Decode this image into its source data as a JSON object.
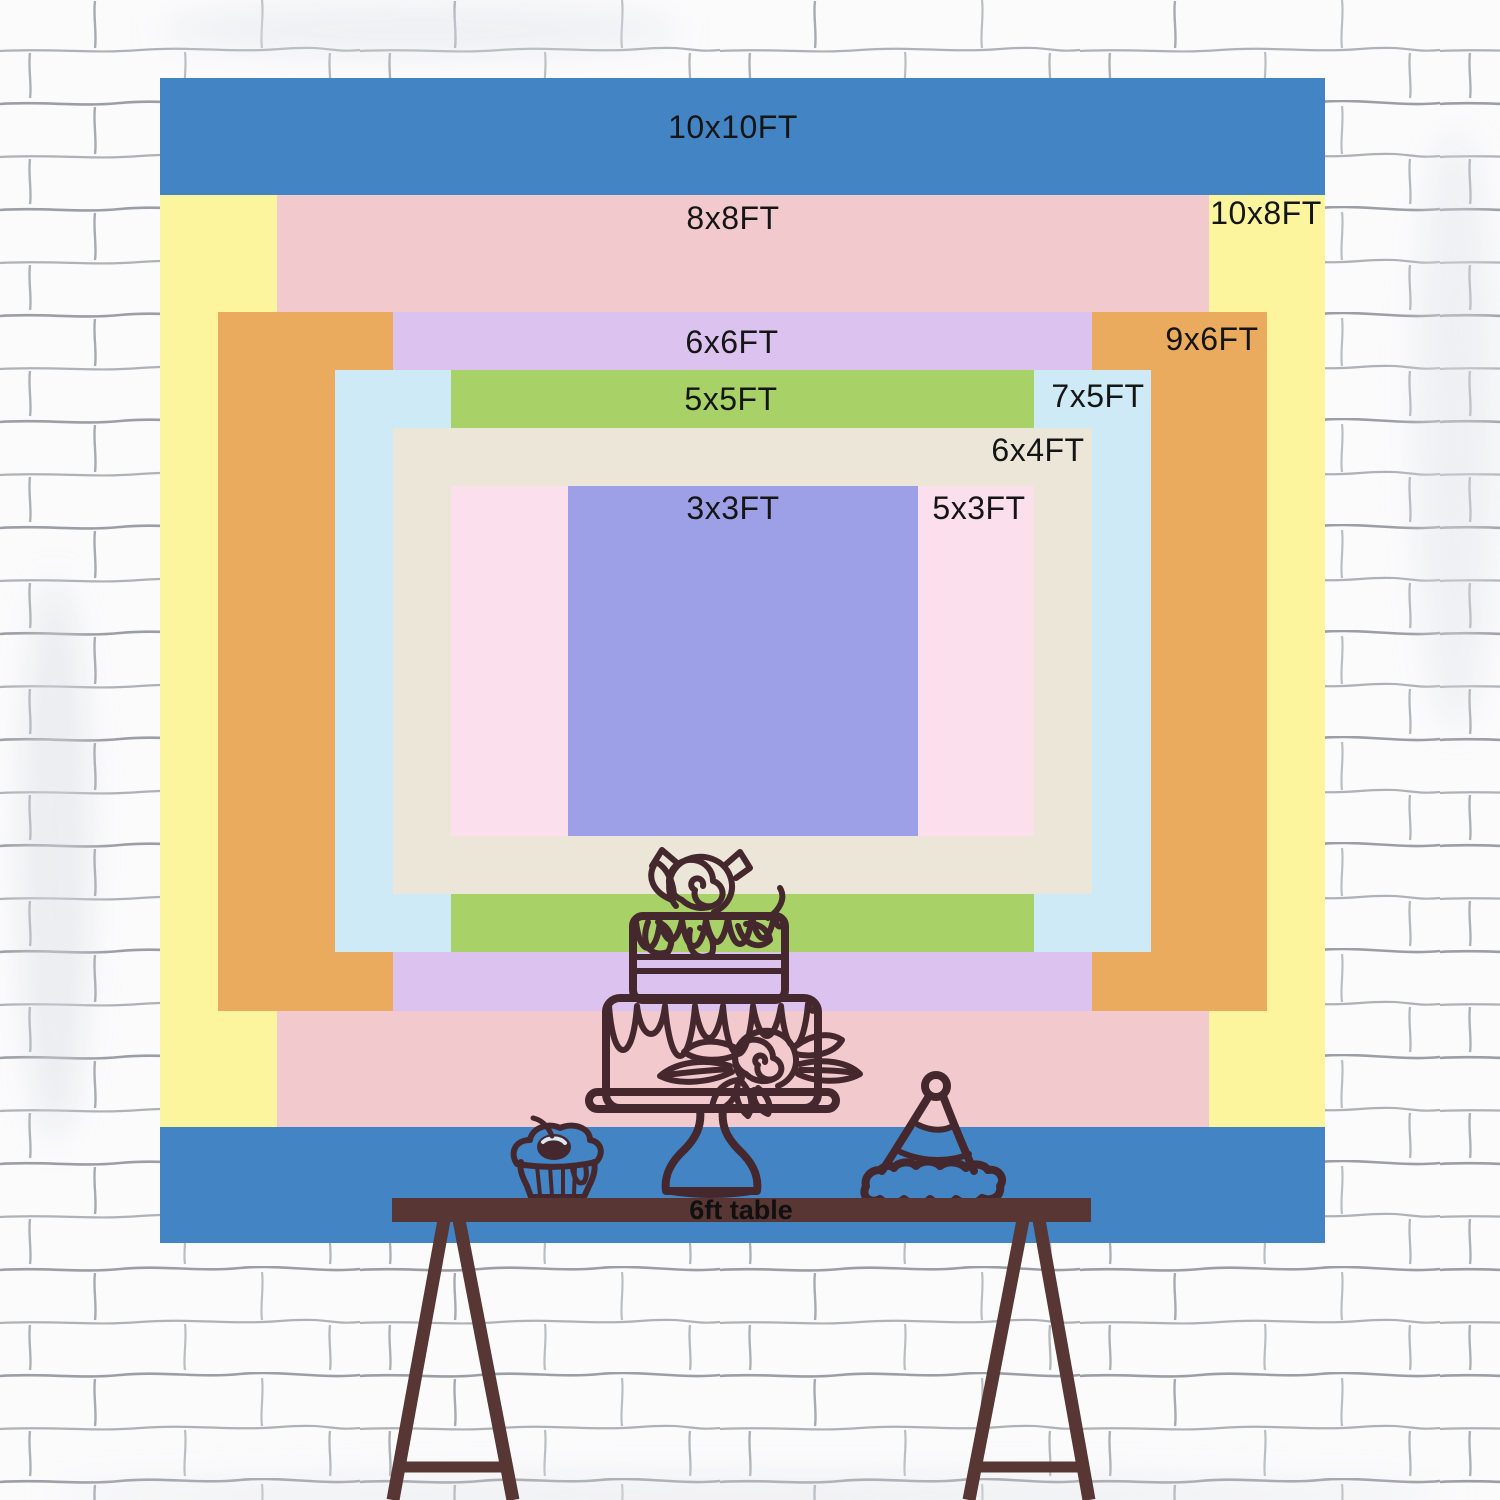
{
  "backdrop": {
    "description": "Backdrop size comparison chart, concentric colored rectangles",
    "layers": [
      {
        "label": "10x10FT",
        "size_ft": {
          "w": 10,
          "h": 10
        },
        "color": "#4284c4",
        "rect": {
          "x": 160,
          "y": 78,
          "w": 1165,
          "h": 1165
        },
        "label_pos": {
          "x": 733,
          "y": 127
        }
      },
      {
        "label": "10x8FT",
        "size_ft": {
          "w": 10,
          "h": 8
        },
        "color": "#fdf59e",
        "rect": {
          "x": 160,
          "y": 195,
          "w": 1165,
          "h": 932
        },
        "label_pos": {
          "x": 1266,
          "y": 213
        }
      },
      {
        "label": "8x8FT",
        "size_ft": {
          "w": 8,
          "h": 8
        },
        "color": "#f2cacd",
        "rect": {
          "x": 277,
          "y": 195,
          "w": 932,
          "h": 932
        },
        "label_pos": {
          "x": 733,
          "y": 218
        }
      },
      {
        "label": "9x6FT",
        "size_ft": {
          "w": 9,
          "h": 6
        },
        "color": "#ebab5f",
        "rect": {
          "x": 218,
          "y": 312,
          "w": 1049,
          "h": 699
        },
        "label_pos": {
          "x": 1212,
          "y": 339
        }
      },
      {
        "label": "6x6FT",
        "size_ft": {
          "w": 6,
          "h": 6
        },
        "color": "#dbc2ef",
        "rect": {
          "x": 393,
          "y": 312,
          "w": 699,
          "h": 699
        },
        "label_pos": {
          "x": 732,
          "y": 342
        }
      },
      {
        "label": "7x5FT",
        "size_ft": {
          "w": 7,
          "h": 5
        },
        "color": "#cdeaf6",
        "rect": {
          "x": 335,
          "y": 370,
          "w": 816,
          "h": 582
        },
        "label_pos": {
          "x": 1098,
          "y": 396
        }
      },
      {
        "label": "5x5FT",
        "size_ft": {
          "w": 5,
          "h": 5
        },
        "color": "#a8d268",
        "rect": {
          "x": 451,
          "y": 370,
          "w": 583,
          "h": 582
        },
        "label_pos": {
          "x": 731,
          "y": 399
        }
      },
      {
        "label": "6x4FT",
        "size_ft": {
          "w": 6,
          "h": 4
        },
        "color": "#ebe6d8",
        "rect": {
          "x": 393,
          "y": 428,
          "w": 699,
          "h": 466
        },
        "label_pos": {
          "x": 1038,
          "y": 450
        }
      },
      {
        "label": "5x3FT",
        "size_ft": {
          "w": 5,
          "h": 3
        },
        "color": "#fcdfec",
        "rect": {
          "x": 451,
          "y": 486,
          "w": 583,
          "h": 350
        },
        "label_pos": {
          "x": 979,
          "y": 508
        }
      },
      {
        "label": "3x3FT",
        "size_ft": {
          "w": 3,
          "h": 3
        },
        "color": "#9da0e7",
        "rect": {
          "x": 568,
          "y": 486,
          "w": 350,
          "h": 350
        },
        "label_pos": {
          "x": 733,
          "y": 508
        }
      }
    ]
  },
  "table": {
    "label": "6ft table"
  },
  "illustrations": {
    "cake": "two-tier-cake-on-stand-icon",
    "cupcake": "cupcake-with-cherry-icon",
    "party_hat": "party-hat-icon",
    "background": "white-brick-wall"
  },
  "colors": {
    "line_art": "#45282e",
    "table_brown": "#573634",
    "wall_line": "#646973",
    "label_text": "#151515"
  }
}
